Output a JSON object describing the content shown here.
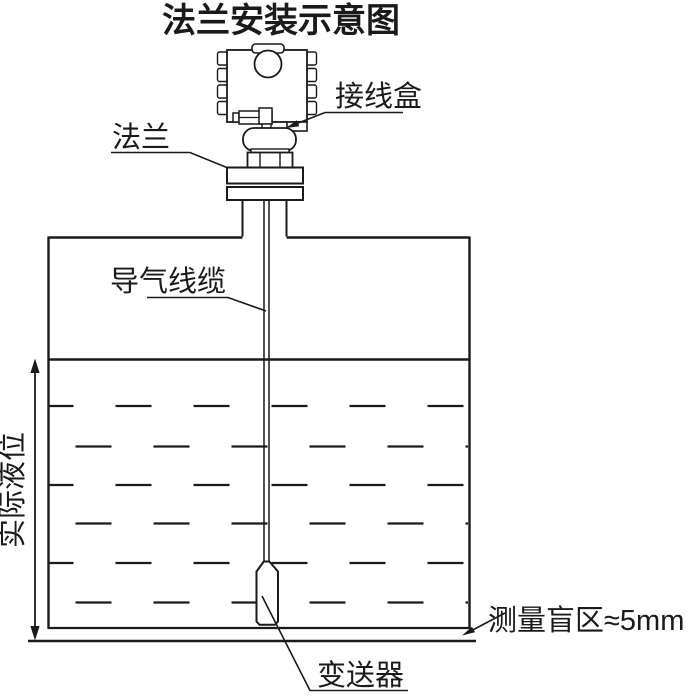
{
  "title": "法兰安装示意图",
  "labels": {
    "junction_box": "接线盒",
    "flange": "法兰",
    "air_cable": "导气线缆",
    "actual_level": "实际液位",
    "blind_zone": "测量盲区≈5mm",
    "transmitter": "变送器"
  },
  "colors": {
    "line": "#1a1a1a",
    "background": "#ffffff"
  },
  "diagram": {
    "type": "flange-mounted level transmitter installation schematic",
    "blind_zone_value": "≈5mm"
  }
}
